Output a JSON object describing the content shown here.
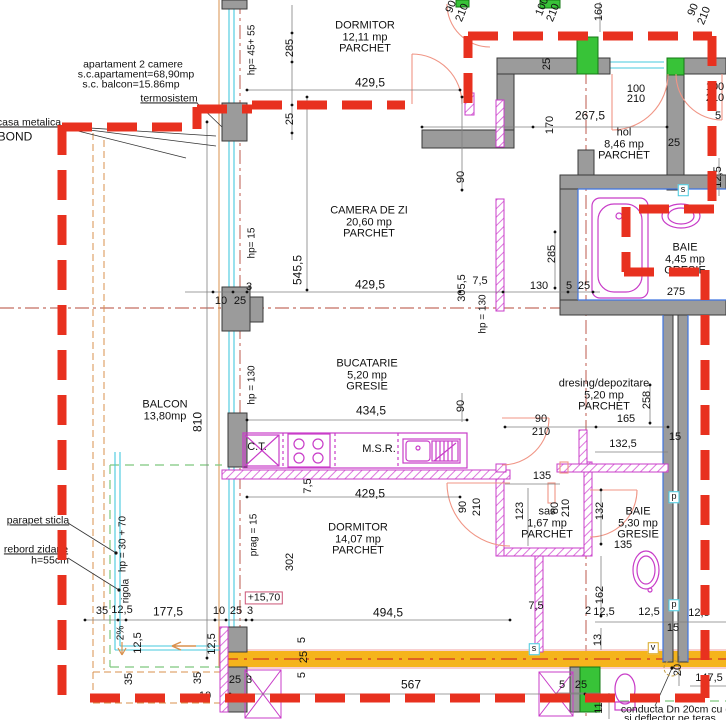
{
  "summary": {
    "type": "apartament 2 camere",
    "area_total": "s.c.apartament=68,90mp",
    "area_balcony": "s.c. balcon=15.86mp"
  },
  "rooms": [
    {
      "n": "room-dormitor-north",
      "lines": [
        "DORMITOR",
        "12,11 mp",
        "PARCHET"
      ],
      "x": 365,
      "y": 38
    },
    {
      "n": "room-camera-de-zi",
      "lines": [
        "CAMERA DE ZI",
        "20,60 mp",
        "PARCHET"
      ],
      "x": 369,
      "y": 223
    },
    {
      "n": "room-bucatarie",
      "lines": [
        "BUCATARIE",
        "5,20 mp",
        "GRESIE"
      ],
      "x": 367,
      "y": 376
    },
    {
      "n": "room-balcon",
      "lines": [
        "BALCON",
        "13,80mp"
      ],
      "x": 165,
      "y": 411
    },
    {
      "n": "room-dormitor-south",
      "lines": [
        "DORMITOR",
        "14,07 mp",
        "PARCHET"
      ],
      "x": 358,
      "y": 540
    },
    {
      "n": "room-hol",
      "lines": [
        "hol",
        "8,46 mp",
        "PARCHET"
      ],
      "x": 624,
      "y": 145
    },
    {
      "n": "room-baie-north",
      "lines": [
        "BAIE",
        "4,45 mp",
        "GRESIE"
      ],
      "x": 685,
      "y": 260
    },
    {
      "n": "room-dresing",
      "lines": [
        "dresing/depozitare",
        "5,20 mp",
        "PARCHET"
      ],
      "x": 604,
      "y": 396
    },
    {
      "n": "room-sas",
      "lines": [
        "sas",
        "1,67 mp",
        "PARCHET"
      ],
      "x": 547,
      "y": 524
    },
    {
      "n": "room-baie-south",
      "lines": [
        "BAIE",
        "5,30 mp",
        "GRESIE"
      ],
      "x": 638,
      "y": 524
    }
  ],
  "callouts": [
    {
      "n": "note-termosistem",
      "t": "termosistem",
      "x": 169,
      "y": 99,
      "u": 1
    },
    {
      "n": "note-casa-metalica",
      "t": "casa metalica",
      "x": 29,
      "y": 123,
      "u": 1
    },
    {
      "n": "note-bond",
      "t": "BOND",
      "x": 15,
      "y": 137,
      "s": 12
    },
    {
      "n": "note-parapet-sticla",
      "t": "parapet sticla",
      "x": 38,
      "y": 521,
      "u": 1
    },
    {
      "n": "note-rebord-zidarie",
      "t": "rebord zidarie",
      "x": 36,
      "y": 550,
      "u": 1
    },
    {
      "n": "note-rebord-h",
      "t": "h=55cm",
      "x": 50,
      "y": 561
    },
    {
      "n": "note-rigola",
      "t": "rigola",
      "x": 127,
      "y": 591,
      "r": -90,
      "s": 10
    },
    {
      "n": "note-rigola-hp",
      "t": "hp = 30 + 70",
      "x": 124,
      "y": 544,
      "r": -90,
      "s": 10
    },
    {
      "n": "note-slope",
      "t": "2%",
      "x": 122,
      "y": 633,
      "r": -90,
      "s": 10
    },
    {
      "n": "level-marker",
      "t": "+15,70",
      "x": 264,
      "y": 598,
      "box": "#cc5577"
    },
    {
      "n": "note-conducta-1",
      "t": "conducta Dn 20cm cu d",
      "x": 676,
      "y": 710
    },
    {
      "n": "note-conducta-2",
      "t": "si deflector pe teras",
      "x": 670,
      "y": 719
    }
  ],
  "dimensions": [
    {
      "t": "429,5",
      "x": 370,
      "y": 83,
      "s": 12
    },
    {
      "t": "285",
      "x": 291,
      "y": 48,
      "r": -90
    },
    {
      "t": "25",
      "x": 291,
      "y": 119,
      "r": -90
    },
    {
      "t": "hp= 45+ 55",
      "x": 253,
      "y": 50,
      "r": -90,
      "s": 10
    },
    {
      "t": "90",
      "x": 452,
      "y": 7,
      "r": -68
    },
    {
      "t": "210",
      "x": 463,
      "y": 13,
      "r": -68
    },
    {
      "t": "100",
      "x": 543,
      "y": 7,
      "r": -68
    },
    {
      "t": "210",
      "x": 554,
      "y": 13,
      "r": -68
    },
    {
      "t": "160",
      "x": 600,
      "y": 12,
      "r": -90
    },
    {
      "t": "90",
      "x": 694,
      "y": 10,
      "r": -68
    },
    {
      "t": "210",
      "x": 705,
      "y": 16,
      "r": -68
    },
    {
      "t": "100",
      "x": 636,
      "y": 90
    },
    {
      "t": "210",
      "x": 636,
      "y": 100
    },
    {
      "t": "100",
      "x": 715,
      "y": 88
    },
    {
      "t": "210",
      "x": 715,
      "y": 99
    },
    {
      "t": "267,5",
      "x": 590,
      "y": 116,
      "s": 12
    },
    {
      "t": "25",
      "x": 548,
      "y": 64,
      "r": -90
    },
    {
      "t": "170",
      "x": 551,
      "y": 125,
      "r": -90
    },
    {
      "t": "25",
      "x": 674,
      "y": 144
    },
    {
      "t": "5",
      "x": 718,
      "y": 117
    },
    {
      "t": "12,5",
      "x": 719,
      "y": 177,
      "r": -90
    },
    {
      "t": "275",
      "x": 676,
      "y": 293
    },
    {
      "t": "285",
      "x": 553,
      "y": 254,
      "r": -90
    },
    {
      "t": "130",
      "x": 539,
      "y": 287
    },
    {
      "t": "5",
      "x": 569,
      "y": 287
    },
    {
      "t": "25",
      "x": 584,
      "y": 287
    },
    {
      "t": "7,5",
      "x": 480,
      "y": 282
    },
    {
      "t": "305,5",
      "x": 463,
      "y": 288,
      "r": -90
    },
    {
      "t": "545,5",
      "x": 298,
      "y": 270,
      "r": -90,
      "s": 12
    },
    {
      "t": "hp= 15",
      "x": 253,
      "y": 243,
      "r": -90,
      "s": 10
    },
    {
      "t": "90",
      "x": 462,
      "y": 177,
      "r": -90
    },
    {
      "t": "429,5",
      "x": 370,
      "y": 285,
      "s": 12
    },
    {
      "t": "3",
      "x": 249,
      "y": 288
    },
    {
      "t": "10",
      "x": 221,
      "y": 302
    },
    {
      "t": "25",
      "x": 240,
      "y": 302
    },
    {
      "t": "hp = 130",
      "x": 484,
      "y": 314,
      "r": -90,
      "s": 10
    },
    {
      "t": "hp = 130",
      "x": 253,
      "y": 385,
      "r": -90,
      "s": 10
    },
    {
      "t": "434,5",
      "x": 371,
      "y": 411,
      "s": 12
    },
    {
      "t": "90",
      "x": 462,
      "y": 406,
      "r": -90
    },
    {
      "t": "C.T.",
      "x": 257,
      "y": 448
    },
    {
      "t": "M.S.R.",
      "x": 379,
      "y": 450
    },
    {
      "t": "90",
      "x": 541,
      "y": 420
    },
    {
      "t": "210",
      "x": 541,
      "y": 433
    },
    {
      "t": "165",
      "x": 626,
      "y": 420
    },
    {
      "t": "258",
      "x": 648,
      "y": 400,
      "r": -90
    },
    {
      "t": "132,5",
      "x": 623,
      "y": 445
    },
    {
      "t": "15",
      "x": 675,
      "y": 438
    },
    {
      "t": "135",
      "x": 542,
      "y": 477
    },
    {
      "t": "123",
      "x": 521,
      "y": 511,
      "r": -90
    },
    {
      "t": "80",
      "x": 556,
      "y": 508,
      "r": -90
    },
    {
      "t": "210",
      "x": 567,
      "y": 508,
      "r": -90
    },
    {
      "t": "90",
      "x": 464,
      "y": 507,
      "r": -90
    },
    {
      "t": "210",
      "x": 478,
      "y": 507,
      "r": -90
    },
    {
      "t": "132",
      "x": 601,
      "y": 511,
      "r": -90
    },
    {
      "t": "135",
      "x": 623,
      "y": 546
    },
    {
      "t": "162",
      "x": 601,
      "y": 595,
      "r": -90
    },
    {
      "t": "7,5",
      "x": 536,
      "y": 607
    },
    {
      "t": "2",
      "x": 588,
      "y": 612
    },
    {
      "t": "12,5",
      "x": 604,
      "y": 613
    },
    {
      "t": "12,5",
      "x": 649,
      "y": 613
    },
    {
      "t": "12,5",
      "x": 699,
      "y": 614
    },
    {
      "t": "15",
      "x": 673,
      "y": 629
    },
    {
      "t": "13",
      "x": 599,
      "y": 640,
      "r": -90
    },
    {
      "t": "5",
      "x": 562,
      "y": 686
    },
    {
      "t": "25",
      "x": 581,
      "y": 686
    },
    {
      "t": "110",
      "x": 600,
      "y": 705,
      "r": -90
    },
    {
      "t": "20",
      "x": 679,
      "y": 670,
      "r": -90
    },
    {
      "t": "147,5",
      "x": 709,
      "y": 679
    },
    {
      "t": "429,5",
      "x": 370,
      "y": 494,
      "s": 12
    },
    {
      "t": "302",
      "x": 291,
      "y": 562,
      "r": -90
    },
    {
      "t": "prag = 15",
      "x": 255,
      "y": 535,
      "r": -90,
      "s": 10
    },
    {
      "t": "7,5",
      "x": 309,
      "y": 486,
      "r": -90
    },
    {
      "t": "494,5",
      "x": 388,
      "y": 613,
      "s": 12
    },
    {
      "t": "35",
      "x": 102,
      "y": 612
    },
    {
      "t": "12,5",
      "x": 122,
      "y": 611
    },
    {
      "t": "177,5",
      "x": 168,
      "y": 612,
      "s": 12
    },
    {
      "t": "10",
      "x": 219,
      "y": 612
    },
    {
      "t": "25",
      "x": 236,
      "y": 612
    },
    {
      "t": "3",
      "x": 250,
      "y": 612
    },
    {
      "t": "12,5",
      "x": 139,
      "y": 643,
      "r": -90
    },
    {
      "t": "12,5",
      "x": 213,
      "y": 644,
      "r": -90
    },
    {
      "t": "35",
      "x": 130,
      "y": 679,
      "r": -90
    },
    {
      "t": "35",
      "x": 199,
      "y": 678,
      "r": -90
    },
    {
      "t": "10",
      "x": 205,
      "y": 697
    },
    {
      "t": "25",
      "x": 235,
      "y": 681
    },
    {
      "t": "3",
      "x": 249,
      "y": 681
    },
    {
      "t": "5",
      "x": 303,
      "y": 640,
      "r": -90
    },
    {
      "t": "25",
      "x": 305,
      "y": 657,
      "r": -90
    },
    {
      "t": "5",
      "x": 303,
      "y": 675,
      "r": -90
    },
    {
      "t": "567",
      "x": 411,
      "y": 685,
      "s": 12
    },
    {
      "t": "810",
      "x": 198,
      "y": 422,
      "r": -90,
      "s": 12
    }
  ],
  "shaft_labels": [
    {
      "n": "shaft-s-top",
      "t": "s",
      "x": 683,
      "y": 190,
      "border": "#45c8de"
    },
    {
      "n": "shaft-p-upper",
      "t": "p",
      "x": 674,
      "y": 497,
      "border": "#45c8de"
    },
    {
      "n": "shaft-p-lower",
      "t": "p",
      "x": 674,
      "y": 605,
      "border": "#45c8de"
    },
    {
      "n": "shaft-s-bottom",
      "t": "s",
      "x": 534,
      "y": 649,
      "border": "#45c8de"
    },
    {
      "n": "shaft-v",
      "t": "v",
      "x": 653,
      "y": 648,
      "border": "#d8a820"
    }
  ],
  "colors": {
    "insulation_red": "#e8311f",
    "wall_gray": "#9b9b9b",
    "column_green": "#38c338",
    "partition_magenta": "#c83cc8",
    "slab_yellow": "#f5b41c",
    "parapet_cyan": "#45c8de",
    "guide_orange": "#d9914e",
    "guide_green": "#7dc87d"
  }
}
